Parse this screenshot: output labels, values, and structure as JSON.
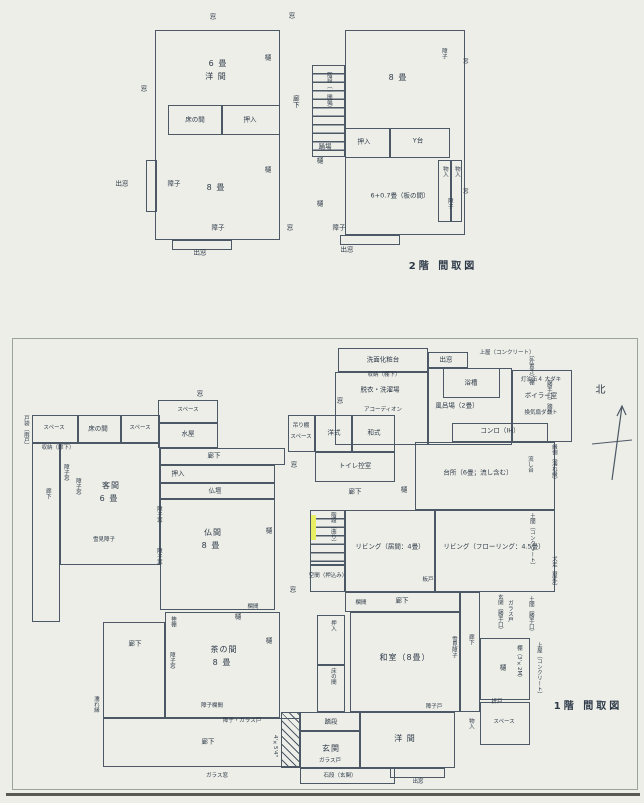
{
  "common": {
    "mado": "窓",
    "demado": "出窓",
    "shoji": "障子",
    "shoji_do": "障子戸",
    "shoji_mado": "障子窓",
    "shoji_glass_do": "障子・ガラス戸",
    "shoji_ranma": "障子欄間",
    "yukimi_shoji": "雪見障子",
    "glass_do": "ガラス戸",
    "glass_mado": "ガラス窓",
    "hi": "樋",
    "oshiire": "押入",
    "monoire": "物入",
    "roka": "廊下",
    "ranma": "欄間",
    "space": "スペース",
    "tokonoma": "床の間",
    "odoriba": "踊場",
    "fumidan": "踏段",
    "tobukuro": "戸袋（雨戸）"
  },
  "floor2": {
    "caption": "2階 間取図",
    "rooms": {
      "west_room_size": "6 畳",
      "west_room_name": "洋 間",
      "sw_room": "8 畳",
      "ne_room": "8 畳",
      "stairs": "階段（一間幅）",
      "ydai": "Y台",
      "se_room": "6+0.7畳（板の間）"
    }
  },
  "floor1": {
    "caption": "1階 間取図",
    "north_label": "北",
    "rooms": {
      "senmen": "洗面化粧台",
      "shunou_tanashita": "収納（棚下）",
      "datsui": "脱衣・洗濯場",
      "accordion": "アコーディオン",
      "yokusou": "浴槽",
      "furoba": "風呂場（2畳）",
      "uwaya": "上屋（コンクリート）",
      "boiler": "ボイラー室",
      "boiler_note": "灯油缶４ 大ダキ",
      "kanki": "換気扇ダクト",
      "sotooki_tana": "（外置き）棚",
      "katteguchi_fumidan": "（勝手口）踏段",
      "engawa_nureen": "縁側（濡れ縁）",
      "konro": "コンロ（IH）",
      "daidokoro": "台所（6畳；流し含む）",
      "nagashidai": "流し台",
      "mizuya": "水屋",
      "kyakuma": "客間",
      "kyakuma_size": "6 畳",
      "shunou_roka": "収納（廊下）",
      "butsudan": "仏壇",
      "butsuma": "仏間",
      "butsuma_size": "8 畳",
      "youshiki": "洋式",
      "washiki": "和式",
      "toilet": "トイレ控室",
      "tsuridana": "吊り棚",
      "kaidan": "階段（曲り）",
      "kuukan": "空間（押込み）",
      "living_ima": "リビング（居間：4畳）",
      "living_flooring": "リビング（フローリング：4.5畳）",
      "itado": "板戸",
      "kamidana": "神棚",
      "chanoma": "茶の間",
      "chanoma_size": "8 畳",
      "washitsu": "和室（8畳）",
      "genkan": "玄関",
      "genkan_dim": "4'×5'4\"",
      "ishidan": "石段（玄関）",
      "youma": "洋 間",
      "orido": "折戸",
      "tana_3x2": "棚（3'×2M）",
      "doma_concrete": "土間（コンクリート）",
      "inubashiri": "犬走（屋外）",
      "genkan_katte": "玄関（勝手口）",
      "doma_katte": "土間（勝手口）",
      "nureen": "濡れ縁"
    }
  }
}
